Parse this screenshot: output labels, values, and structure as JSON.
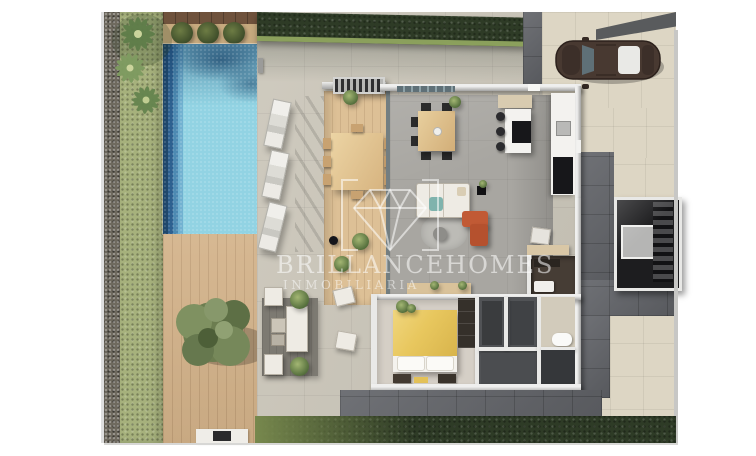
{
  "watermark": {
    "brand_first": "BRILLANCE",
    "brand_second": "HOMES",
    "subtitle": "INMOBILIARIA",
    "logo": "diamond-gem-in-brackets"
  },
  "scene_objects": [
    "swimming-pool",
    "pool-steps",
    "sun-loungers",
    "palm-trees",
    "boxwood-bushes",
    "lawn-strip",
    "gravel-strip",
    "wooden-deck",
    "olive-tree",
    "barbecue",
    "outdoor-lounge-set",
    "outdoor-dining-table",
    "pergola",
    "stone-patio",
    "top-hedge",
    "bottom-hedge",
    "driveway",
    "parked-car",
    "indoor-dining-table",
    "kitchen-island",
    "kitchen-counter",
    "fridge",
    "living-sofa",
    "orange-armchair",
    "round-rug",
    "coffee-table",
    "console-desk",
    "upper-bathroom",
    "double-bed-yellow",
    "wardrobe",
    "dressing-rooms",
    "lower-bathroom",
    "toilet",
    "shower",
    "interior-staircase",
    "elevator",
    "exterior-stairs",
    "side-paths"
  ],
  "colors": {
    "page": "#ffffff",
    "gravel": "#6e695e",
    "grass": "#a6b17c",
    "hedge": "#2e3b26",
    "hedgeLight": "#8ba05c",
    "poolLight": "#92d3e3",
    "stone": "#cac5b8",
    "pathBeige": "#ddd6c4",
    "tileDark": "#63656a",
    "wall": "#a3a3a2",
    "wallLight": "#efefee",
    "floorGray": "#a8a6a1",
    "woodDeck": "#d3b289",
    "woodDark": "#6f523c",
    "sand": "#c6a97e",
    "floorWood": "#ddc096",
    "kitchenWhite": "#f3f2ef",
    "appliance": "#17171a",
    "sofaWhite": "#eeebe4",
    "accentOrange": "#c15a35",
    "bedYellow": "#e8c75e",
    "rug": "#bcbbb6",
    "carBody": "#483931",
    "glassTeal": "#5f7077",
    "roomDark": "#463d35",
    "wingDark": "#515356",
    "stairBlack": "#1d1d1f",
    "elevator": "#b5b5b4",
    "fence": "#c7c7c5"
  }
}
